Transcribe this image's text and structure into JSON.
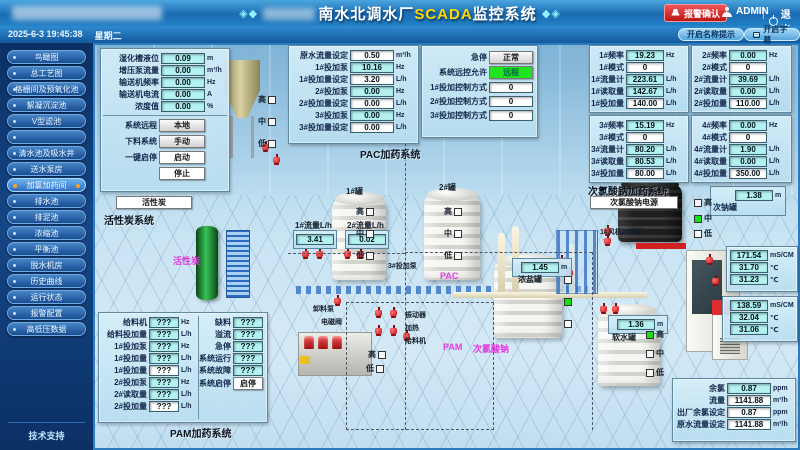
{
  "header": {
    "title_prefix": "南水北调水厂",
    "title_scada": "SCADA",
    "title_suffix": "监控系统",
    "deco_left": "◈◆",
    "deco_right": "◆◈",
    "alarm_button": "报警确认",
    "user": "ADMIN",
    "logout": "退出",
    "datetime": "2025-6-3  19:45:38",
    "weekday": "星期二",
    "btn_name_tip": "开启名称提示",
    "btn_subtitle": "开启字幕"
  },
  "sidebar": {
    "items": [
      {
        "label": "鸟瞰图"
      },
      {
        "label": "总工艺图"
      },
      {
        "label": "格栅间及预氧化池"
      },
      {
        "label": "絮凝沉淀池"
      },
      {
        "label": "V型滤池"
      },
      {
        "label": ""
      },
      {
        "label": "清水池及吸水井"
      },
      {
        "label": "送水泵房"
      },
      {
        "label": "加氯加药间"
      },
      {
        "label": "排水池"
      },
      {
        "label": "排泥池"
      },
      {
        "label": "浓缩池"
      },
      {
        "label": "平衡池"
      },
      {
        "label": "脱水机房"
      },
      {
        "label": "历史曲线"
      },
      {
        "label": "运行状态"
      },
      {
        "label": "报警配置"
      },
      {
        "label": "高低压数据"
      }
    ],
    "support": "技术支持"
  },
  "carbon": {
    "rows": [
      {
        "label": "湿化槽液位",
        "value": "0.09",
        "unit": "m"
      },
      {
        "label": "增压泵流量",
        "value": "0.00",
        "unit": "m³/h"
      },
      {
        "label": "输送机频率",
        "value": "0.00",
        "unit": "Hz"
      },
      {
        "label": "输送机电流",
        "value": "0.00",
        "unit": "A"
      },
      {
        "label": "浓度值",
        "value": "0.00",
        "unit": "%"
      }
    ],
    "remote_label": "系统远程",
    "remote_value": "本地",
    "feed_label": "下料系统",
    "feed_value": "手动",
    "onekey_label": "一键启停",
    "start": "启动",
    "stop": "停止",
    "carbon_button": "活性炭",
    "title": "活性炭系统"
  },
  "pac": {
    "rows": [
      {
        "label": "原水流量设定",
        "value": "0.50",
        "unit": "m³/h"
      },
      {
        "label": "1#投加泵",
        "value": "10.16",
        "unit": "Hz"
      },
      {
        "label": "1#投加量设定",
        "value": "3.20",
        "unit": "L/h"
      },
      {
        "label": "2#投加泵",
        "value": "0.00",
        "unit": "Hz"
      },
      {
        "label": "2#投加量设定",
        "value": "0.00",
        "unit": "L/h"
      },
      {
        "label": "3#投加泵",
        "value": "0.00",
        "unit": "Hz"
      },
      {
        "label": "3#投加量设定",
        "value": "0.00",
        "unit": "L/h"
      }
    ],
    "title": "PAC加药系统"
  },
  "ctrl": {
    "estop_label": "急停",
    "estop_value": "正常",
    "remote_label": "系统远控允许",
    "remote_value": "远程",
    "rows": [
      {
        "label": "1#投加控制方式",
        "value": "0"
      },
      {
        "label": "2#投加控制方式",
        "value": "0"
      },
      {
        "label": "3#投加控制方式",
        "value": "0"
      }
    ]
  },
  "naclo": {
    "title": "次氯酸钠加药系统",
    "power_button": "次氯酸钠电源",
    "pumps": [
      {
        "rows": [
          {
            "label": "1#频率",
            "value": "19.23",
            "unit": "Hz"
          },
          {
            "label": "1#模式",
            "value": "0",
            "unit": ""
          },
          {
            "label": "1#流量计",
            "value": "223.61",
            "unit": "L/h"
          },
          {
            "label": "1#读取量",
            "value": "142.67",
            "unit": "L/h"
          },
          {
            "label": "1#投加量",
            "value": "140.00",
            "unit": "L/h"
          }
        ]
      },
      {
        "rows": [
          {
            "label": "2#频率",
            "value": "0.00",
            "unit": "Hz"
          },
          {
            "label": "2#模式",
            "value": "0",
            "unit": ""
          },
          {
            "label": "2#流量计",
            "value": "39.69",
            "unit": "L/h"
          },
          {
            "label": "2#读取量",
            "value": "0.00",
            "unit": "L/h"
          },
          {
            "label": "2#投加量",
            "value": "110.00",
            "unit": "L/h"
          }
        ]
      },
      {
        "rows": [
          {
            "label": "3#频率",
            "value": "15.19",
            "unit": "Hz"
          },
          {
            "label": "3#模式",
            "value": "0",
            "unit": ""
          },
          {
            "label": "3#流量计",
            "value": "80.20",
            "unit": "L/h"
          },
          {
            "label": "3#读取量",
            "value": "80.53",
            "unit": "L/h"
          },
          {
            "label": "3#投加量",
            "value": "80.00",
            "unit": "L/h"
          }
        ]
      },
      {
        "rows": [
          {
            "label": "4#频率",
            "value": "0.00",
            "unit": "Hz"
          },
          {
            "label": "4#模式",
            "value": "0",
            "unit": ""
          },
          {
            "label": "4#流量计",
            "value": "1.90",
            "unit": "L/h"
          },
          {
            "label": "4#读取量",
            "value": "0.00",
            "unit": "L/h"
          },
          {
            "label": "4#投加量",
            "value": "350.00",
            "unit": "L/h"
          }
        ]
      }
    ],
    "tank_value": "1.38",
    "tank_unit": "m",
    "tank_label": "次钠罐",
    "fans_label": "1#风机2#风机"
  },
  "cond1": {
    "rows": [
      {
        "value": "171.54",
        "unit": "mS/CM"
      },
      {
        "value": "31.70",
        "unit": "℃"
      },
      {
        "value": "31.23",
        "unit": "℃"
      }
    ]
  },
  "cond2": {
    "rows": [
      {
        "value": "138.59",
        "unit": "mS/CM"
      },
      {
        "value": "32.04",
        "unit": "℃"
      },
      {
        "value": "31.06",
        "unit": "℃"
      }
    ]
  },
  "outlet": {
    "rows": [
      {
        "label": "余氯",
        "value": "0.87",
        "unit": "ppm"
      },
      {
        "label": "流量",
        "value": "1141.88",
        "unit": "m³/h"
      },
      {
        "label": "出厂余氯设定",
        "value": "0.87",
        "unit": "ppm"
      },
      {
        "label": "原水流量设定",
        "value": "1141.88",
        "unit": "m³/h"
      }
    ]
  },
  "pam": {
    "left_rows": [
      {
        "label": "给料机",
        "value": "???",
        "unit": "Hz"
      },
      {
        "label": "给料投加量",
        "value": "???",
        "unit": "L/h"
      },
      {
        "label": "1#投加泵",
        "value": "???",
        "unit": "Hz"
      },
      {
        "label": "1#投加量",
        "value": "???",
        "unit": "L/h"
      },
      {
        "label": "1#投加量",
        "value": "???",
        "unit": "L/h"
      },
      {
        "label": "2#投加泵",
        "value": "???",
        "unit": "Hz"
      },
      {
        "label": "2#读取量",
        "value": "???",
        "unit": "L/h"
      },
      {
        "label": "2#投加量",
        "value": "???",
        "unit": "L/h"
      }
    ],
    "right_rows": [
      {
        "label": "缺料",
        "value": "???"
      },
      {
        "label": "溢流",
        "value": "???"
      },
      {
        "label": "急停",
        "value": "???"
      },
      {
        "label": "系统运行",
        "value": "???"
      },
      {
        "label": "系统故障",
        "value": "???"
      }
    ],
    "startstop_label": "系统启停",
    "startstop_button": "启停",
    "title": "PAM加药系统"
  },
  "scene": {
    "carbon_area": "活性炭",
    "pac_area": "PAC",
    "pam_area": "PAM",
    "naclo_area": "次氯酸钠",
    "tank1_label": "1#罐",
    "tank2_label": "2#罐",
    "flow1_label": "1#流量L/h",
    "flow1_value": "3.41",
    "flow2_label": "2#流量L/h",
    "flow2_value": "0.02",
    "pump3_label": "3#投加泵",
    "brine_value": "1.45",
    "brine_unit": "m",
    "brine_label": "浓盐罐",
    "soft_value": "1.36",
    "soft_unit": "m",
    "soft_label": "软水罐",
    "unload_pump": "卸料泵",
    "solenoid": "电磁阀",
    "vibrator": "振动器",
    "heater": "加热",
    "feeder": "给料机",
    "lvl_high": "高",
    "lvl_mid": "中",
    "lvl_low": "低"
  }
}
